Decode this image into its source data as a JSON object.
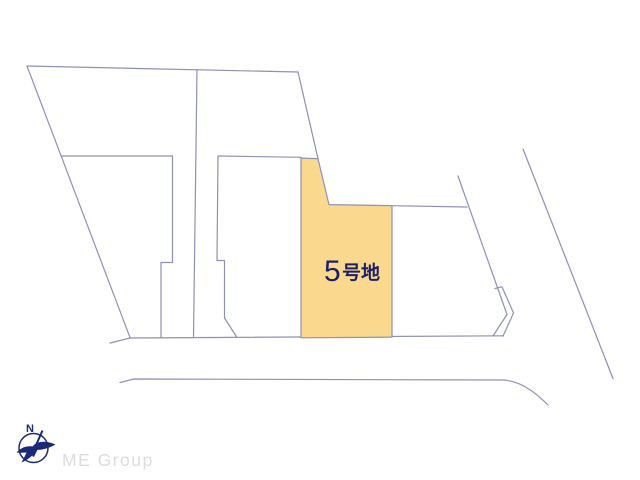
{
  "page": {
    "background": "#ffffff",
    "description": "Residential site plan drawing with highlighted lot"
  },
  "plan": {
    "line_color": "#8e90b8",
    "highlight_lot": {
      "label_number": "5",
      "label_suffix": "号地",
      "label_color": "#1c2166",
      "fill_color": "#fad98f"
    }
  },
  "branding": {
    "company": "ME Group",
    "text_color": "#dcdcdc",
    "compass_letter": "N",
    "logo_color": "#1b2a78"
  }
}
